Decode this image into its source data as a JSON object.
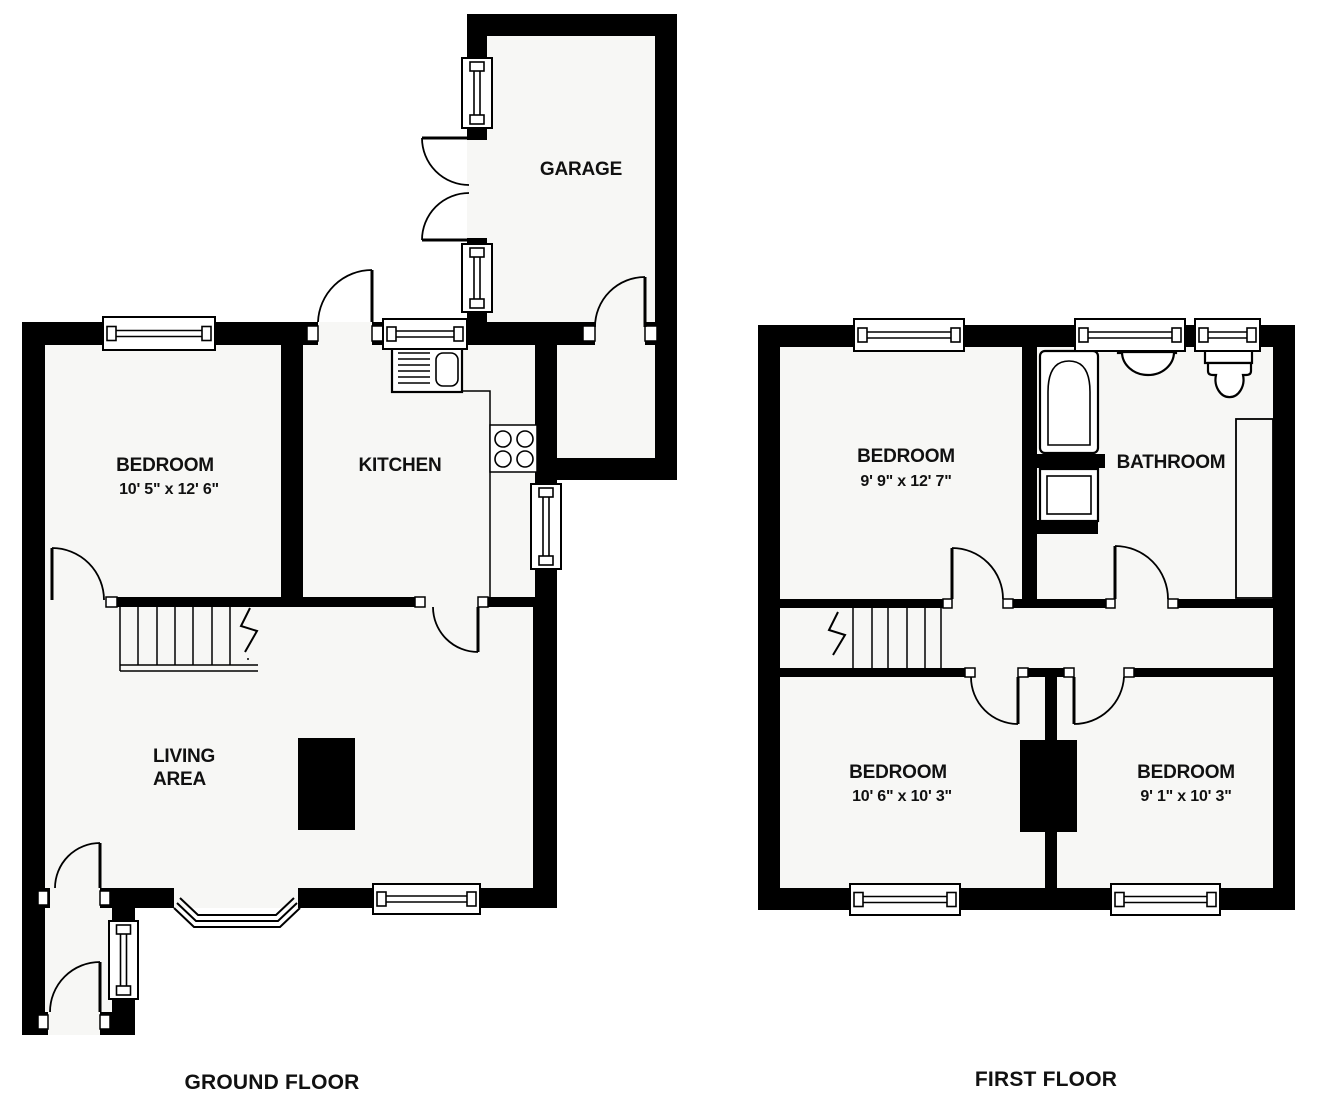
{
  "ground_floor": {
    "title": "GROUND FLOOR",
    "rooms": {
      "garage": {
        "name": "GARAGE"
      },
      "bedroom": {
        "name": "BEDROOM",
        "dims": "10' 5\" x 12' 6\""
      },
      "kitchen": {
        "name": "KITCHEN"
      },
      "living_area": {
        "name_line1": "LIVING",
        "name_line2": "AREA"
      }
    }
  },
  "first_floor": {
    "title": "FIRST FLOOR",
    "rooms": {
      "bedroom_1": {
        "name": "BEDROOM",
        "dims": "9' 9\" x 12' 7\""
      },
      "bathroom": {
        "name": "BATHROOM"
      },
      "bedroom_2": {
        "name": "BEDROOM",
        "dims": "10' 6\" x 10' 3\""
      },
      "bedroom_3": {
        "name": "BEDROOM",
        "dims": "9' 1\" x 10' 3\""
      }
    }
  },
  "colors": {
    "wall": "#000000",
    "room_fill": "#f7f7f5",
    "background": "#ffffff"
  }
}
